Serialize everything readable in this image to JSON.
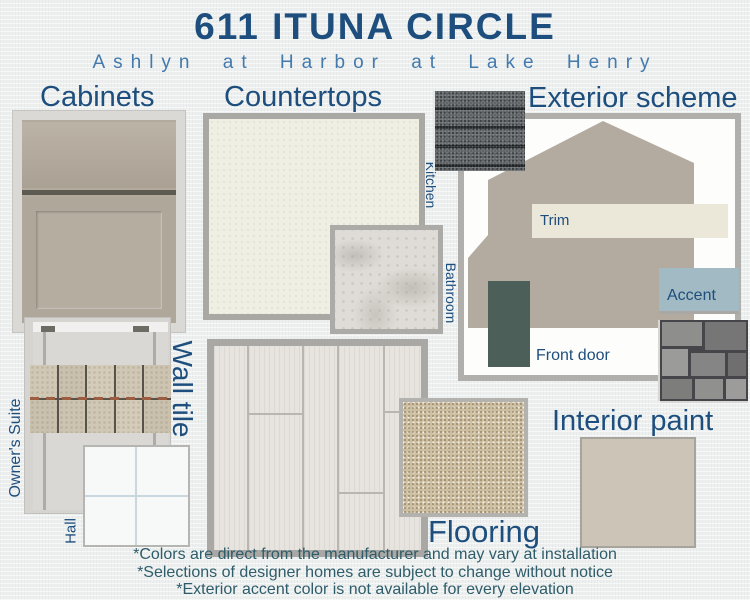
{
  "header": {
    "title": "611 ITUNA CIRCLE",
    "subtitle": "Ashlyn at Harbor at Lake Henry"
  },
  "sections": {
    "cabinets": {
      "label": "Cabinets"
    },
    "countertops": {
      "label": "Countertops",
      "kitchen": "Kitchen",
      "bathroom": "Bathroom"
    },
    "exterior": {
      "label": "Exterior scheme",
      "trim": "Trim",
      "accent": "Accent",
      "front_door": "Front door"
    },
    "wall_tile": {
      "label": "Wall tile",
      "owners_suite": "Owner's Suite",
      "hall": "Hall"
    },
    "flooring": {
      "label": "Flooring"
    },
    "interior_paint": {
      "label": "Interior paint"
    }
  },
  "disclaimers": [
    "*Colors are direct from the manufacturer and may vary at installation",
    "*Selections of designer homes are subject to change without notice",
    "*Exterior accent color is not available for every elevation"
  ],
  "colors": {
    "heading_navy": "#1d4e7d",
    "subtitle_blue": "#4379ad",
    "disclaimer_teal": "#2e5c6a",
    "cabinet_taupe": "#b3aa9e",
    "countertop_cream": "#f0efe4",
    "bathroom_marble": "#dfdcd7",
    "house_body_taupe": "#b4aba0",
    "trim_cream": "#ebe8da",
    "front_door_slate": "#4d5f59",
    "accent_blue_gray": "#a2bac3",
    "interior_paint_greige": "#cbc4b7",
    "flooring_wood": "#e7e4e0",
    "carpet_beige": "#cdbfa2",
    "accent_tile_beige": "#d0c7b5",
    "roof_shingle_gray": "#5d6164"
  }
}
